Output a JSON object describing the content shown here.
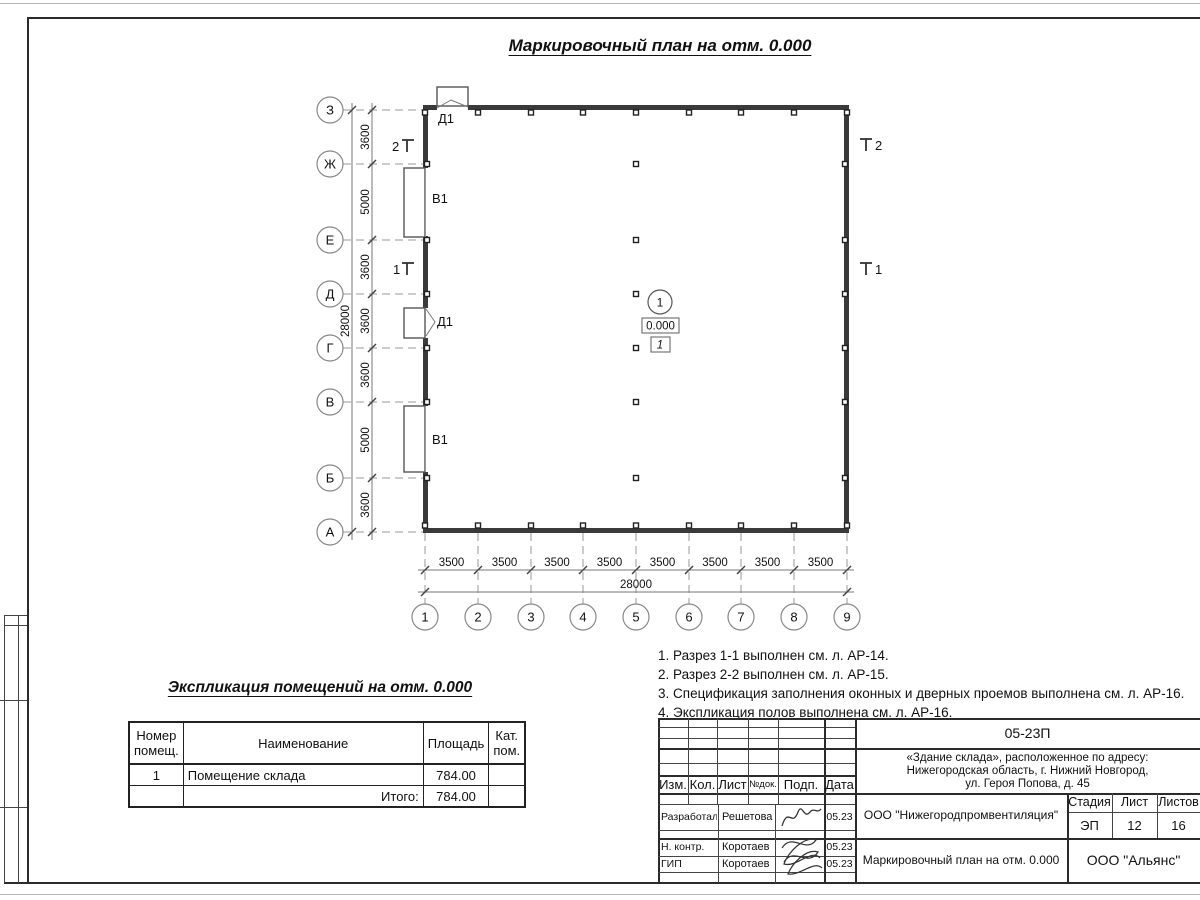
{
  "plan": {
    "title": "Маркировочный план на отм. 0.000",
    "row_axes": [
      "З",
      "Ж",
      "Е",
      "Д",
      "Г",
      "В",
      "Б",
      "А"
    ],
    "col_axes": [
      "1",
      "2",
      "3",
      "4",
      "5",
      "6",
      "7",
      "8",
      "9"
    ],
    "row_dims": [
      "3600",
      "5000",
      "3600",
      "3600",
      "3600",
      "5000",
      "3600"
    ],
    "col_dims": [
      "3500",
      "3500",
      "3500",
      "3500",
      "3500",
      "3500",
      "3500",
      "3500"
    ],
    "row_total": "28000",
    "col_total": "28000",
    "labels": {
      "door_top": "Д1",
      "gate_upper": "В1",
      "door_left": "Д1",
      "gate_lower": "В1"
    },
    "sections": {
      "s2_left": "2",
      "s1_left": "1",
      "s2_right": "2",
      "s1_right": "1"
    },
    "room": {
      "number": "1",
      "elevation": "0.000",
      "floor_mark": "1"
    }
  },
  "notes": {
    "items": [
      "1. Разрез 1-1 выполнен см. л. АР-14.",
      "2. Разрез 2-2 выполнен см. л. АР-15.",
      "3. Спецификация заполнения оконных и дверных проемов выполнена см. л. АР-16.",
      "4. Экспликация полов выполнена см. л. АР-16."
    ]
  },
  "explication": {
    "title": "Экспликация помещений на отм. 0.000",
    "col_number": "Номер помещ.",
    "col_name": "Наименование",
    "col_area": "Площадь",
    "col_cat": "Кат. пом.",
    "row_number": "1",
    "row_name": "Помещение склада",
    "row_area": "784.00",
    "total_label": "Итого:",
    "total_area": "784.00"
  },
  "title_block": {
    "code": "05-23П",
    "address1": "«Здание склада», расположенное по адресу:",
    "address2": "Нижегородская область, г. Нижний Новгород,",
    "address3": "ул. Героя Попова, д. 45",
    "h_izm": "Изм.",
    "h_kol": "Кол.",
    "h_list": "Лист",
    "h_ndok": "№док.",
    "h_podp": "Подп.",
    "h_data": "Дата",
    "r1_role": "Разработал",
    "r1_name": "Решетова",
    "r1_date": "05.23",
    "r2_role": "Н. контр.",
    "r2_name": "Коротаев",
    "r2_date": "05.23",
    "r3_role": "ГИП",
    "r3_name": "Коротаев",
    "r3_date": "05.23",
    "org": "ООО \"Нижегородпромвентиляция\"",
    "doc_title": "Маркировочный план на отм. 0.000",
    "h_stage": "Стадия",
    "h_sheet": "Лист",
    "h_sheets": "Листов",
    "stage": "ЭП",
    "sheet": "12",
    "sheets": "16",
    "company": "ООО \"Альянс\""
  }
}
